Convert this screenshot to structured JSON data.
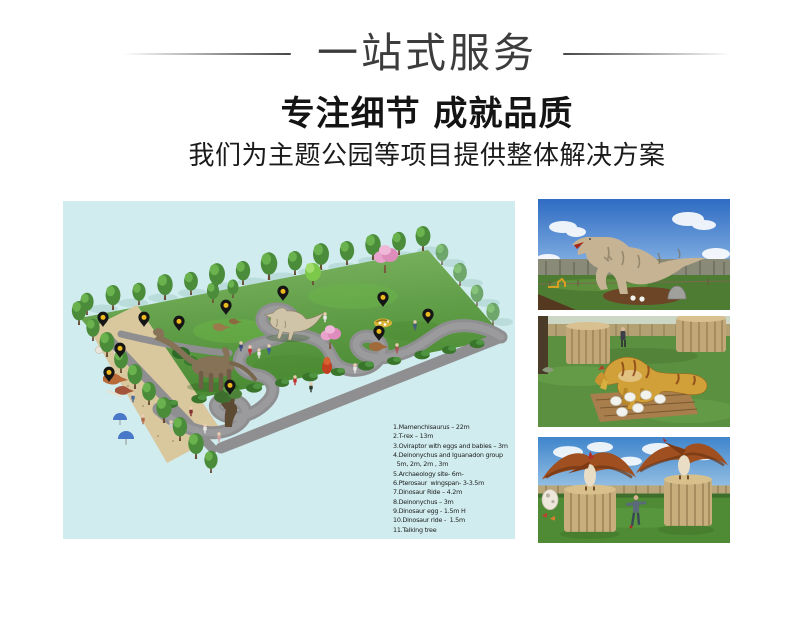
{
  "header": {
    "title": "一站式服务",
    "subtitle": "专注细节 成就品质",
    "tagline": "我们为主题公园等项目提供整体解决方案"
  },
  "colors": {
    "heading_dark": "#3c3c3c",
    "text_black": "#1e1e1e",
    "map_background": "#d0ecee",
    "lawn_green": "#5aa23d",
    "sand": "#d9c79d",
    "path_gray": "#8f8f91",
    "pin_body": "#151515",
    "pin_dot": "#edba1e"
  },
  "park_map": {
    "name": "dinosaur-theme-park-plan",
    "pin_count": 11,
    "legend_items": [
      "1.Mamenchisaurus – 22m",
      "2.T-rex – 13m",
      "3.Oviraptor with eggs and babies – 3m",
      "4.Deinonychus and Iguanadon group",
      "  5m, 2m, 2m , 3m",
      "5.Archaeology site- 6m-",
      "6.Pterosaur  wingspan- 3-3.5m",
      "7.Dinosaur Ride – 4.2m",
      "8.Deinonychus – 3m",
      "9.Dinosaur egg - 1.5m H",
      "10.Dinosaur ride -  1.5m",
      "11.Talking tree"
    ]
  },
  "photos": [
    {
      "name": "t-rex-animatronic-photo"
    },
    {
      "name": "oviraptor-with-eggs-photo"
    },
    {
      "name": "pterosaurs-on-towers-photo"
    }
  ]
}
